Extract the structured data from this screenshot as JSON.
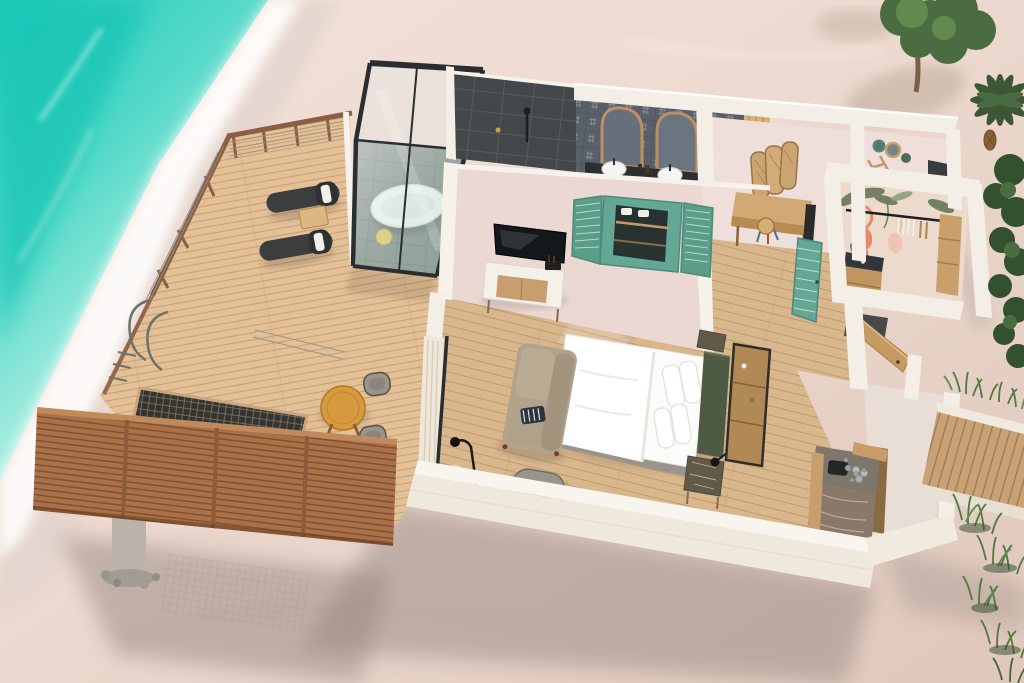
{
  "scene": {
    "name": "overwater-beach-villa-3d-floor-plan",
    "rooms": [
      "sun-deck",
      "glass-bathtub-pavilion",
      "bathroom",
      "bedroom",
      "dressing-corridor",
      "wc-room",
      "walk-in-wardrobe",
      "entry-vestibule",
      "beach-walkway"
    ],
    "furniture": [
      "lounge-chairs",
      "deck-side-table",
      "bistro-table",
      "bistro-chairs",
      "net-hammock",
      "swim-ladder",
      "privacy-slat-screen",
      "freestanding-bathtub",
      "bath-stool",
      "walk-in-shower",
      "double-vanity",
      "arched-mirrors",
      "vessel-sinks",
      "louvered-window",
      "tv",
      "tv-console",
      "king-bed",
      "pillows",
      "headboard",
      "marble-nightstand",
      "wall-lamp",
      "wardrobe-shelf",
      "sofa",
      "striped-cushion",
      "armchair-with-breakfast-tray",
      "floor-lamp",
      "ghost-chair",
      "rattan-trifold-screen",
      "writing-desk",
      "painted-stool",
      "waste-bin",
      "basket-set",
      "clothes-rail",
      "hangers",
      "safe-cabinet",
      "teal-louver-door",
      "entry-door",
      "entry-bench",
      "pebbles",
      "minibar-coffee-station"
    ]
  },
  "palette": {
    "ocean_deep": "#1ec9ba",
    "ocean_mid": "#55d9c8",
    "ocean_light": "#aceee2",
    "ocean_edge": "#dcf7f0",
    "foam": "#ffffff",
    "sand_base": "#ecd8ce",
    "sand_light": "#f4e4da",
    "sand_shade": "#dfc7bc",
    "shadow": "#8f817a",
    "deck_wood": "#e3c096",
    "deck_line": "#c79f74",
    "rail_brown": "#8a5f44",
    "fence_wood": "#aa7048",
    "fence_line": "#7c4f30",
    "net_dark": "#35342f",
    "net_line": "#8d8b80",
    "frame_black": "#2b2e31",
    "glass_tint": "#cfe6e2",
    "tub_white": "#f4f5f1",
    "stool_yellow": "#e6c34b",
    "wall_cream": "#f4efe6",
    "wall_face": "#efe8dc",
    "wall_pink": "#ecd8d3",
    "slate": "#42474a",
    "tile_bg": "#59606a",
    "mirror_wood": "#bd8f63",
    "sink_white": "#f5f5f3",
    "teal": "#63a794",
    "teal_dark": "#4d8a78",
    "floor_wood": "#d9b78d",
    "floor_line": "#c09468",
    "bed_white": "#fbfbf9",
    "headboard_green": "#4e5a44",
    "sofa_beige": "#b2a38d",
    "chair_dark": "#3c3d3f",
    "chair_grey": "#99948c",
    "wood_mid": "#c99e6f",
    "wood_deep": "#b08954",
    "marble": "#615a48",
    "wallpaper": "#ecdacd",
    "flamingo": "#e58a6b",
    "leaf": "#5e7152",
    "foliage_dark": "#33502f",
    "foliage_mid": "#4b6c41",
    "foliage_light": "#628a50",
    "grass": "#4f7a3d",
    "walkway": "#c8a175",
    "pillar": "#b9b3ab",
    "table_orange": "#d89a3e",
    "curtain": "#efe7d9"
  }
}
